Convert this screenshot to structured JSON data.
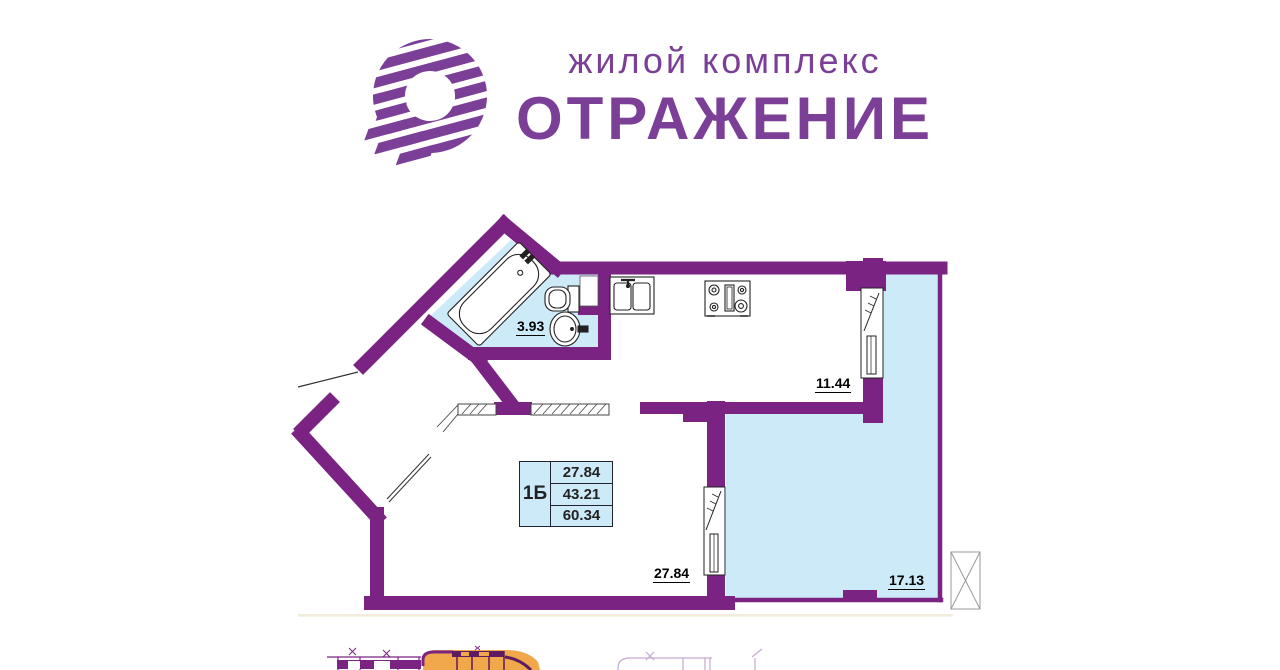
{
  "header": {
    "subtitle": "жилой комплекс",
    "title": "ОТРАЖЕНИЕ"
  },
  "plan": {
    "rooms": [
      {
        "id": "bathroom",
        "area": "3.93"
      },
      {
        "id": "kitchen",
        "area": "11.44"
      },
      {
        "id": "living-room",
        "area": "27.84"
      },
      {
        "id": "balcony",
        "area": "17.13"
      }
    ],
    "info_table": {
      "unit_type": "1Б",
      "rows": [
        "27.84",
        "43.21",
        "60.34"
      ]
    },
    "colors": {
      "walls": "#7a2383",
      "floor_accent": "#cdeaf8",
      "logo": "#7c3f97",
      "thumbnail_orange": "#f0a84a"
    }
  }
}
